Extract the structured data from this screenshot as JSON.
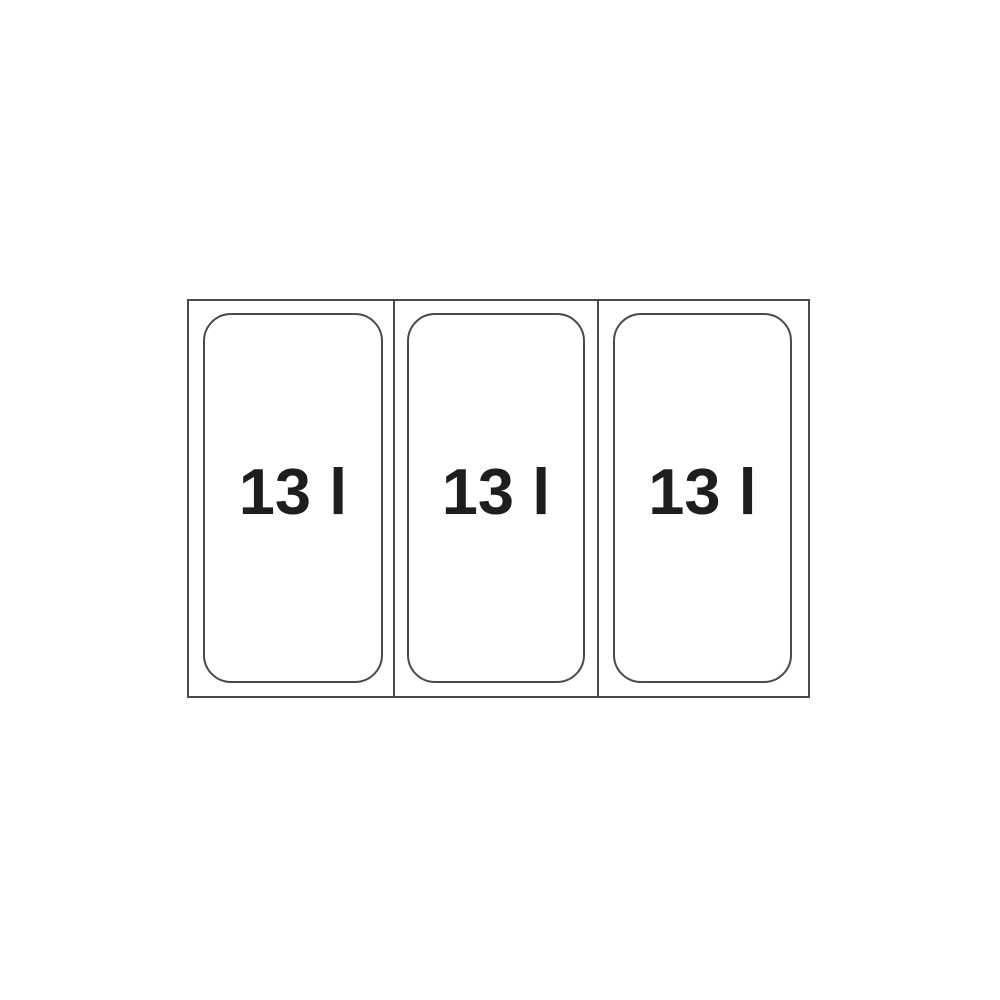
{
  "diagram": {
    "bins": [
      {
        "capacity_label": "13 l"
      },
      {
        "capacity_label": "13 l"
      },
      {
        "capacity_label": "13 l"
      }
    ],
    "colors": {
      "background": "#ffffff",
      "line": "#4a4a4a",
      "text": "#1e1e1e"
    }
  }
}
